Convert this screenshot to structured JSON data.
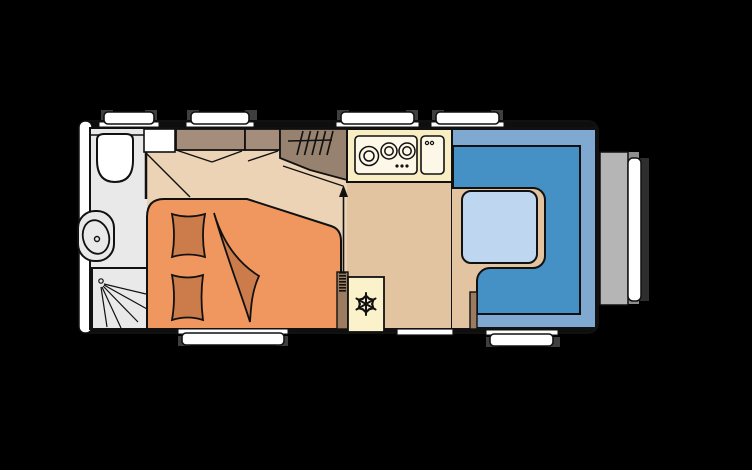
{
  "meta": {
    "title": "Caravan floor plan",
    "view": "top-down"
  },
  "colors": {
    "bg": "#000000",
    "outline": "#111111",
    "wall": "#ffffff",
    "body": "#0e0e0e",
    "bathroom": "#e9e9e9",
    "floorMain": "#e3c4a0",
    "floorBedroom": "#ecd3b5",
    "cabinet": "#a58d7c",
    "wardrobe": "#97816f",
    "kitchenCounter": "#f9edc4",
    "appliance": "#fcf7e6",
    "fridge": "#fbf2cc",
    "bed": "#f0975f",
    "bedding": "#cc7c4a",
    "loungeBack": "#7fa9d1",
    "loungeSeat": "#4590c5",
    "table": "#bed6ef",
    "wood": "#9b7c61",
    "grayBox": "#b5b5b5",
    "grayNotch": "#8f8f8f",
    "darkPanel": "#2e2e2e",
    "windowCap": "#3f3f3f",
    "windowPane": "#ffffff"
  },
  "rooms": [
    {
      "name": "washroom",
      "features": [
        "toilet",
        "washbasin",
        "shower"
      ]
    },
    {
      "name": "bedroom",
      "features": [
        "french-bed",
        "pillow",
        "pillow",
        "duvet",
        "overhead-cabinets",
        "wardrobe-hanging-rail"
      ]
    },
    {
      "name": "kitchen",
      "features": [
        "hob-3-burners",
        "kitchen-sink",
        "refrigerator"
      ]
    },
    {
      "name": "lounge",
      "features": [
        "u-shaped-seating",
        "table"
      ]
    }
  ],
  "fixtures": {
    "hob_burners": 3,
    "pillows": 2,
    "fridge_icon": "snowflake",
    "walk_direction": "arrow-up",
    "heater": "coil"
  },
  "openings": {
    "top_windows": 4,
    "bottom_windows": 2,
    "entry_door": 1
  },
  "exterior": [
    "front-storage-box",
    "cover-panel",
    "bumper-strip"
  ]
}
